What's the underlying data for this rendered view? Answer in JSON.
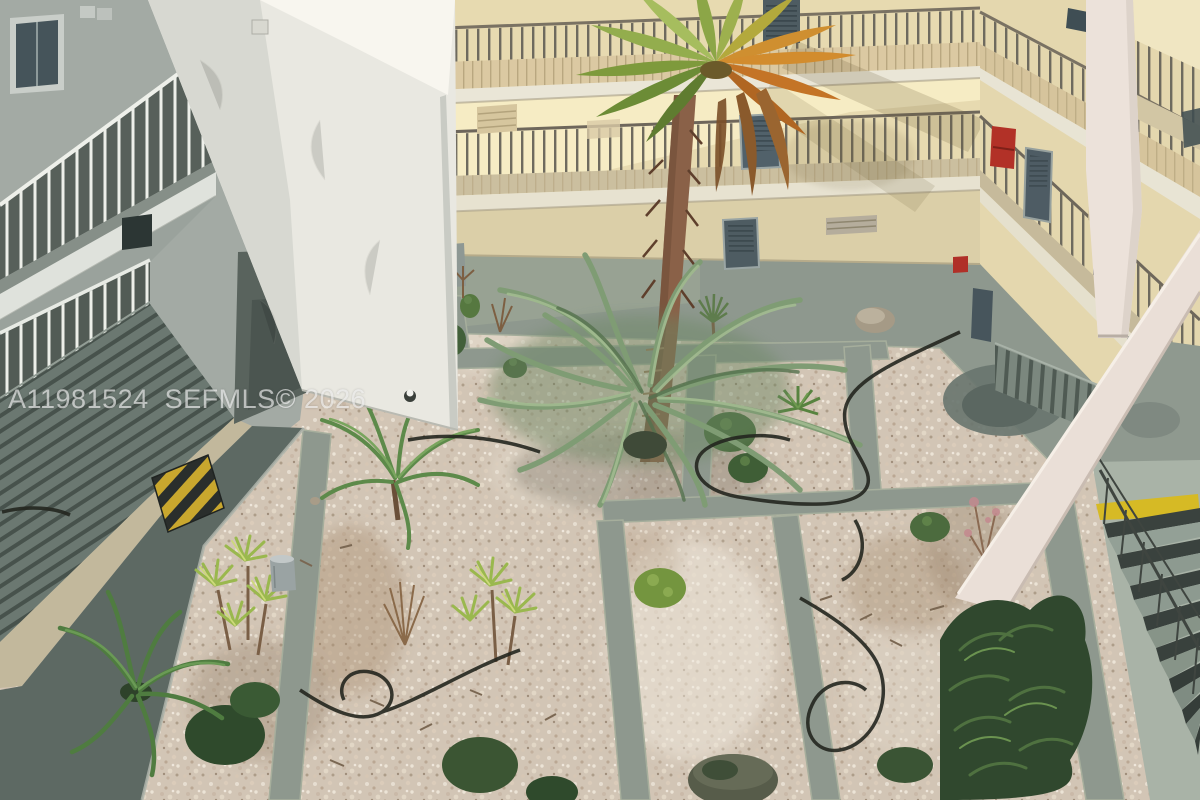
{
  "watermark": {
    "text": "A11981524  SEFMLS© 2026"
  },
  "scene": {
    "setting": "Elevated daytime view into an apartment complex interior courtyard",
    "features": [
      "tall fan palm with green and orange fronds",
      "feathery pygmy date palm in gravel garden",
      "gravel beds with shrubs, dracaenas and irrigation hoses",
      "gray concrete pathway grid",
      "multi-story open walkways with metal railings",
      "white stucco support column in foreground",
      "exterior staircase with yellow safety edge",
      "red fire extinguisher box on wall",
      "black and yellow striped doormat"
    ]
  },
  "palette": {
    "gravel": "#d2c5b5",
    "path_concrete": "#8e988e",
    "back_wall": "#e7dab0",
    "right_wall": "#e4d7ae",
    "left_wall": "#a3aaa4",
    "column_white": "#e9e8e1",
    "stair_column": "#ece2da",
    "beam": "#eadfd7",
    "fire_box_red": "#b23127",
    "safety_yellow": "#d6ba25",
    "pygmy_green": "#6a8662",
    "palm_green": "#7e9a3c",
    "palm_orange": "#d28c2e",
    "palm_trunk": "#8a6148",
    "walkway_shade": "#5d6963",
    "watermark_color": "rgba(252,252,252,0.62)"
  }
}
